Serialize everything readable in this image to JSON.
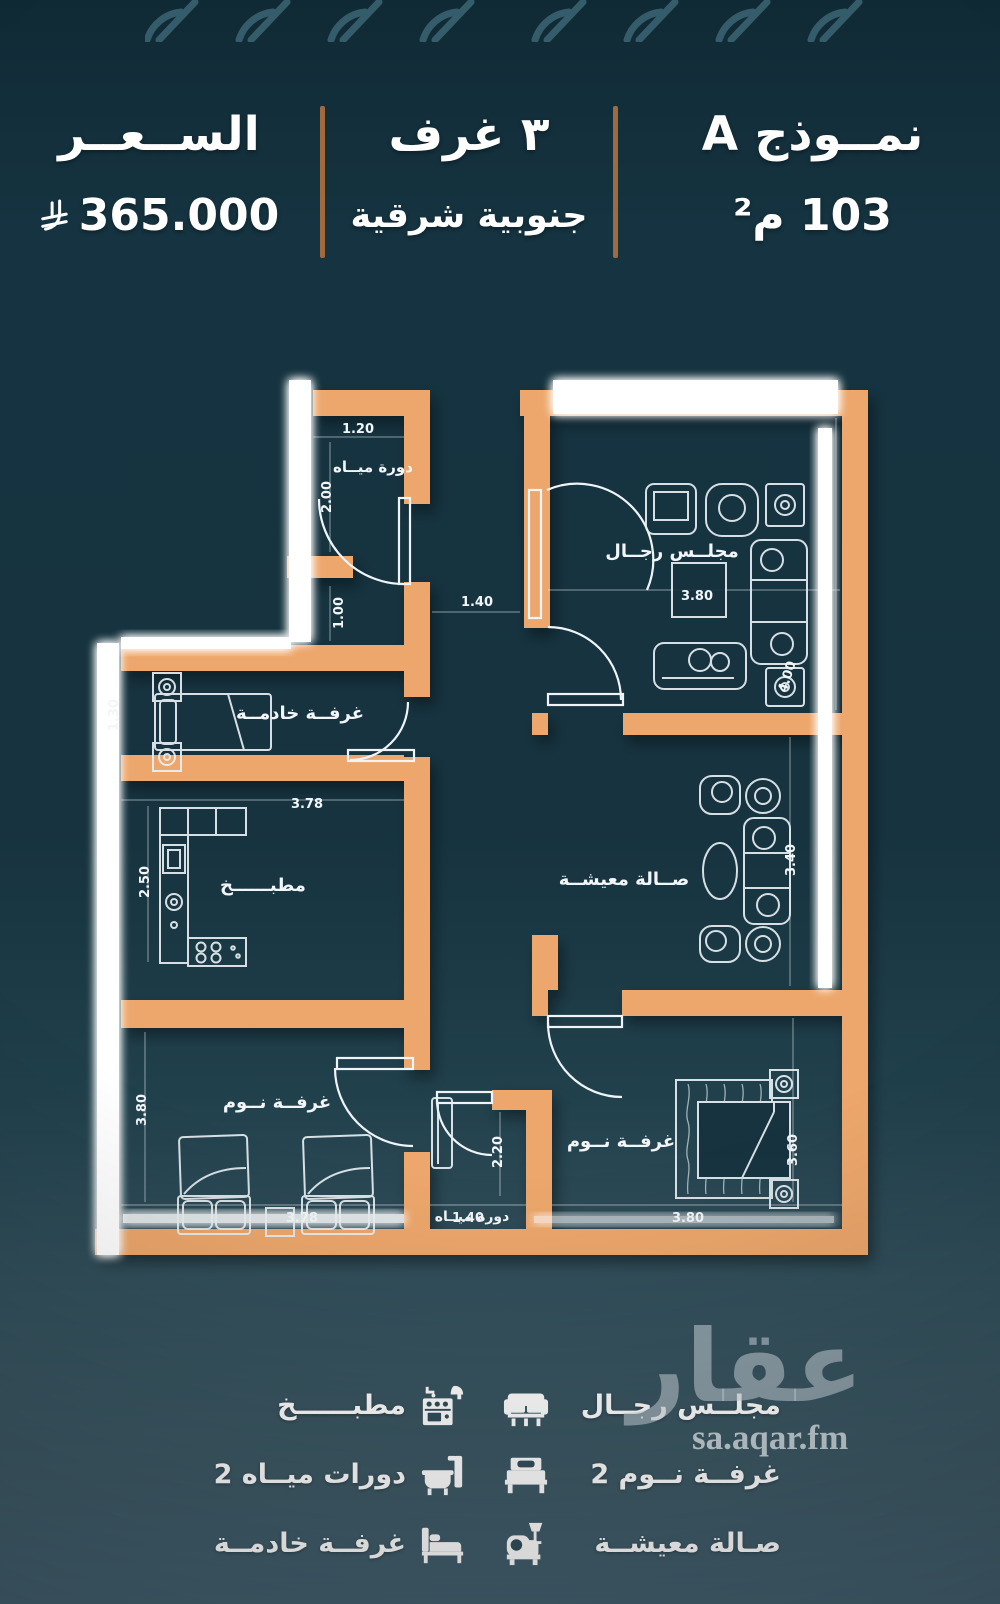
{
  "header": {
    "model_title": "نمــوذج A",
    "model_area": "103 م²",
    "rooms_count": "٣ غرف",
    "orientation": "جنوبية شرقية",
    "price_label": "الســعــر",
    "price_value": "365.000",
    "currency_icon": "saudi-riyal-icon"
  },
  "plan": {
    "rooms": [
      {
        "label": "دورة ميــاه"
      },
      {
        "label": "مجلــس رجــال"
      },
      {
        "label": "غرفــة خادمــة"
      },
      {
        "label": "مطبــــــخ"
      },
      {
        "label": "صــالة معيشــة"
      },
      {
        "label": "غرفــة نــوم"
      },
      {
        "label": "غرفــة نــوم"
      },
      {
        "label": "دورة ميــاه"
      }
    ],
    "dims": [
      "1.20",
      "2.00",
      "1.00",
      "1.40",
      "3.80",
      "4.00",
      "1.30",
      "3.78",
      "2.50",
      "3.40",
      "3.80",
      "3.78",
      "1.40",
      "2.20",
      "3.80",
      "3.60"
    ]
  },
  "legend": {
    "right": [
      {
        "icon": "majlis-sofa-icon",
        "label": "مجلــس رجــال"
      },
      {
        "icon": "bed-icon",
        "label": "2 غرفــة نــوم"
      },
      {
        "icon": "living-armchair-icon",
        "label": "صـالة معيشــة"
      }
    ],
    "left": [
      {
        "icon": "kitchen-stove-icon",
        "label": "مطبــــــخ"
      },
      {
        "icon": "bathtub-icon",
        "label": "2 دورات ميــاه"
      },
      {
        "icon": "single-bed-icon",
        "label": "غرفــة خادمــة"
      }
    ]
  },
  "watermark": {
    "brand": "عقار",
    "site": "sa.aqar.fm"
  },
  "colors": {
    "background_top": "#153340",
    "background_bottom": "#446271",
    "wall": "#eda76c",
    "divider": "#a06a3e",
    "drawing_line": "#ffffff",
    "text": "#ffffff",
    "watermark": "#c8d3da"
  }
}
